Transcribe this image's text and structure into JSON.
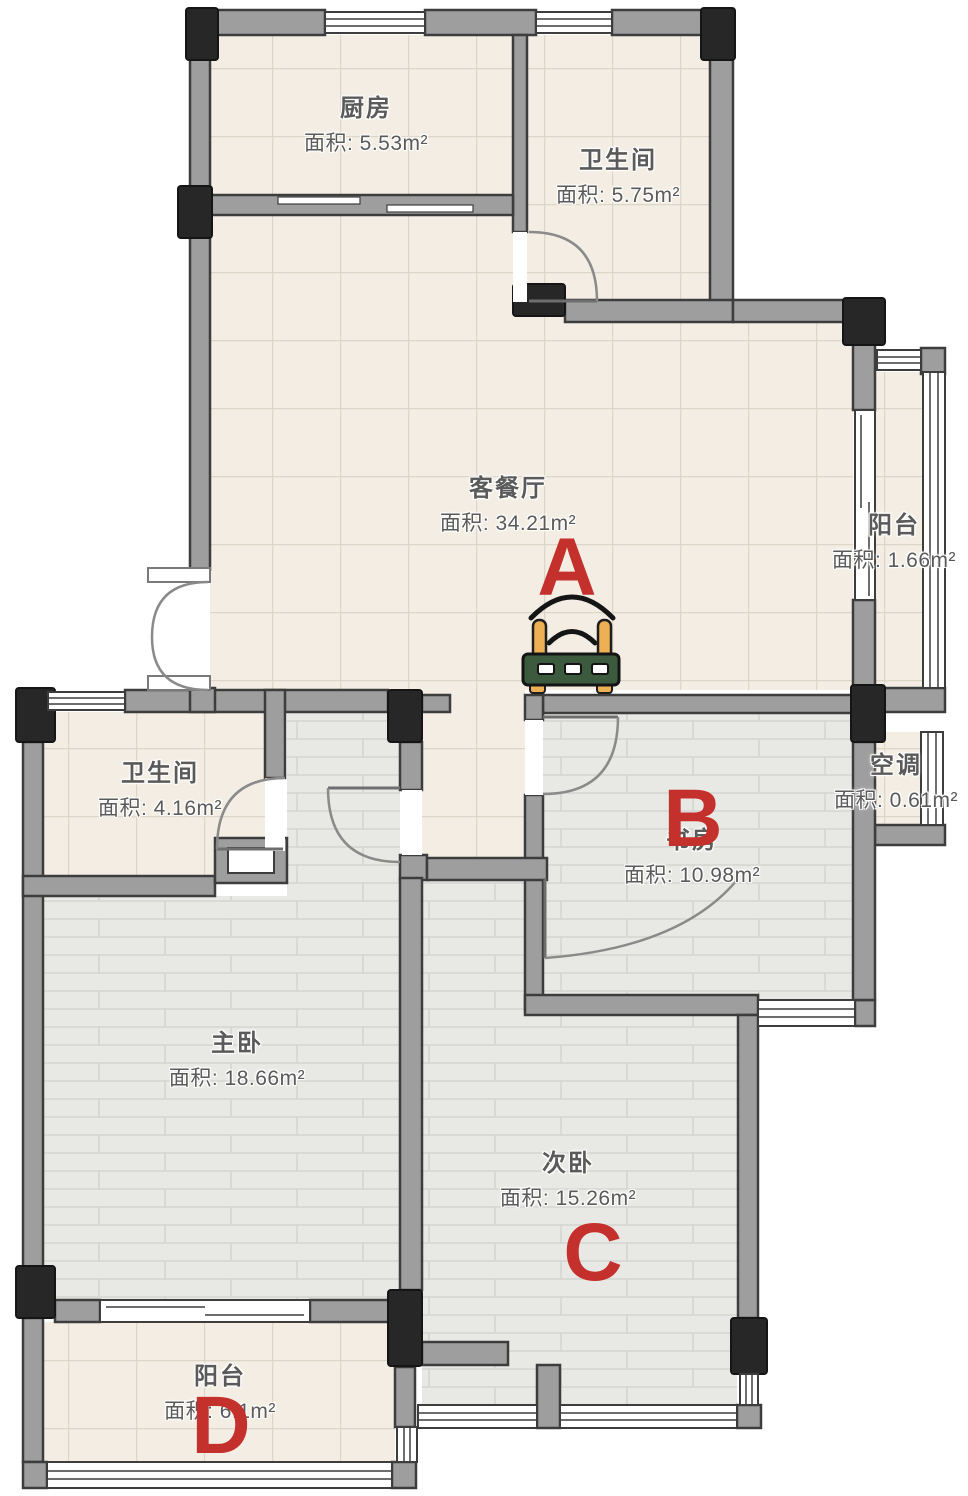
{
  "plan_title": "apartment-floor-plan",
  "rooms": [
    {
      "id": "kitchen",
      "name": "厨房",
      "area": "面积: 5.53m²"
    },
    {
      "id": "bathroom-top",
      "name": "卫生间",
      "area": "面积: 5.75m²"
    },
    {
      "id": "living-dining",
      "name": "客餐厅",
      "area": "面积: 34.21m²"
    },
    {
      "id": "balcony-right",
      "name": "阳台",
      "area": "面积: 1.66m²"
    },
    {
      "id": "air-conditioner",
      "name": "空调",
      "area": "面积: 0.61m²"
    },
    {
      "id": "study",
      "name": "书房",
      "area": "面积: 10.98m²"
    },
    {
      "id": "bathroom-lower",
      "name": "卫生间",
      "area": "面积: 4.16m²"
    },
    {
      "id": "master-bedroom",
      "name": "主卧",
      "area": "面积: 18.66m²"
    },
    {
      "id": "second-bedroom",
      "name": "次卧",
      "area": "面积: 15.26m²"
    },
    {
      "id": "balcony-bottom",
      "name": "阳台",
      "area": "面积: 6.1m²"
    }
  ],
  "markers": [
    {
      "label": "A",
      "location": "living-dining"
    },
    {
      "label": "B",
      "location": "study"
    },
    {
      "label": "C",
      "location": "second-bedroom"
    },
    {
      "label": "D",
      "location": "balcony-bottom"
    }
  ],
  "icons": {
    "router": "wifi-router-icon"
  },
  "colors": {
    "marker_red": "#c4302b",
    "wall_gray": "#9e9e9e",
    "column_black": "#272727",
    "floor_tile": "#f3ede3",
    "floor_brick": "#e8e8e4",
    "router_body_green": "#3c5a3e",
    "router_antenna_orange": "#edb054"
  }
}
